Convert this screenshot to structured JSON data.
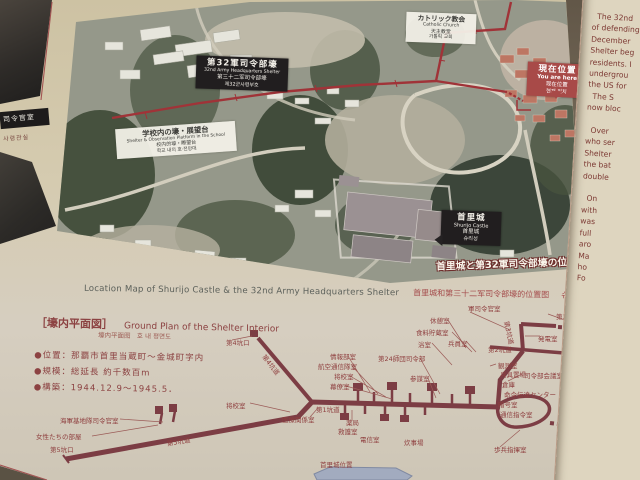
{
  "board": {
    "photo_title_overlay": "首里城と第32軍司令部壕の位置図",
    "caption": {
      "en": "Location Map of Shurijo Castle & the 32nd Army Headquarters Shelter",
      "cn": "首里城和第三十二军司令部壕的位置图",
      "kr": "슈리성과 제32군 사령부호의 위치도"
    }
  },
  "photo_labels": {
    "hq": {
      "jp": "第32軍司令部壕",
      "en": "32nd Army Headquarters Shelter",
      "cn": "第三十二军司令部壕",
      "kr": "제32군사령부호"
    },
    "church": {
      "jp": "カトリック教会",
      "en": "Catholic Church",
      "cn": "天主教堂",
      "kr": "가톨릭 교회"
    },
    "school": {
      "jp": "学校内の壕・展望台",
      "en": "Shelter & Observation Platform in the School",
      "cn": "校内的壕・瞭望台",
      "kr": "학교 내의 호·전망대"
    },
    "here": {
      "jp": "現在位置",
      "en": "You are here",
      "cn": "现在位置",
      "kr": "현재 위치"
    },
    "castle": {
      "jp": "首里城",
      "en": "Shurijo Castle",
      "cn": "首里城",
      "kr": "슈리성"
    }
  },
  "plan": {
    "title_jp": "［壕内平面図］",
    "title_en": "Ground Plan of the Shelter Interior",
    "subtitle": "壕内平面图　호 내 평면도",
    "bullets": [
      "●位置：那覇市首里当蔵町～金城町字内",
      "●規模：総延長 約千数百m",
      "●構築：1944.12.9～1945.5．"
    ],
    "labels": [
      {
        "text": "第4坑口",
        "x": 226,
        "y": 337
      },
      {
        "text": "第4坑道",
        "x": 268,
        "y": 352,
        "rot": 52
      },
      {
        "text": "情報部室",
        "x": 330,
        "y": 351
      },
      {
        "text": "航空通信隊室",
        "x": 318,
        "y": 361
      },
      {
        "text": "将校室",
        "x": 334,
        "y": 371
      },
      {
        "text": "幕僚室",
        "x": 330,
        "y": 381
      },
      {
        "text": "第1坑道",
        "x": 316,
        "y": 404
      },
      {
        "text": "医療関係室",
        "x": 282,
        "y": 414
      },
      {
        "text": "薬局",
        "x": 346,
        "y": 417
      },
      {
        "text": "救護室",
        "x": 338,
        "y": 426
      },
      {
        "text": "電信室",
        "x": 360,
        "y": 434
      },
      {
        "text": "炊事場",
        "x": 404,
        "y": 437
      },
      {
        "text": "第24師団司令部",
        "x": 378,
        "y": 353
      },
      {
        "text": "参謀室",
        "x": 410,
        "y": 373
      },
      {
        "text": "軍司令官室",
        "x": 468,
        "y": 303
      },
      {
        "text": "休憩室",
        "x": 430,
        "y": 315
      },
      {
        "text": "食料貯蔵室",
        "x": 416,
        "y": 327
      },
      {
        "text": "浴室",
        "x": 418,
        "y": 339
      },
      {
        "text": "兵員室",
        "x": 448,
        "y": 338
      },
      {
        "text": "第3坑道",
        "x": 512,
        "y": 320,
        "rot": 78
      },
      {
        "text": "第3坑口",
        "x": 556,
        "y": 311
      },
      {
        "text": "発電室",
        "x": 538,
        "y": 333
      },
      {
        "text": "第2坑道",
        "x": 488,
        "y": 344
      },
      {
        "text": "第2坑口",
        "x": 570,
        "y": 357
      },
      {
        "text": "観測室",
        "x": 498,
        "y": 360
      },
      {
        "text": "兵具置場",
        "x": 500,
        "y": 369
      },
      {
        "text": "司令部会議室",
        "x": 524,
        "y": 370
      },
      {
        "text": "倉庫",
        "x": 502,
        "y": 379
      },
      {
        "text": "命令伝達センター",
        "x": 504,
        "y": 389
      },
      {
        "text": "暗号室",
        "x": 498,
        "y": 399
      },
      {
        "text": "通信指令室",
        "x": 500,
        "y": 409
      },
      {
        "text": "第1坑口",
        "x": 556,
        "y": 431
      },
      {
        "text": "歩兵指揮室",
        "x": 494,
        "y": 444
      },
      {
        "text": "将校室",
        "x": 226,
        "y": 400
      },
      {
        "text": "海軍基地隊司令官室",
        "x": 60,
        "y": 415
      },
      {
        "text": "女性たちの部屋",
        "x": 36,
        "y": 431
      },
      {
        "text": "第5坑口",
        "x": 50,
        "y": 444
      },
      {
        "text": "第5坑道",
        "x": 166,
        "y": 438,
        "rot": -9
      },
      {
        "text": "首里城位置",
        "x": 320,
        "y": 459
      }
    ]
  },
  "side_panel": {
    "lines": [
      "  The 32nd",
      "of defending",
      "December",
      "Shelter beg",
      "residents. I",
      "undergrou",
      "the US for",
      "  The S",
      "now bloc",
      "",
      "  Over",
      "who ser",
      "Shelter",
      "the bat",
      "double",
      "",
      "  On",
      "with",
      "was",
      "full",
      "aro",
      "Ma",
      "ho",
      "Fo"
    ]
  },
  "left_panel": {
    "label_jp": "司令官室",
    "label_kr": "사령관실"
  },
  "colors": {
    "board": "#d3c9ae",
    "tunnel": "#7c3d44",
    "route_red": "#a03338",
    "label_red": "#8f3f3f",
    "here_box": "#a84a48"
  }
}
